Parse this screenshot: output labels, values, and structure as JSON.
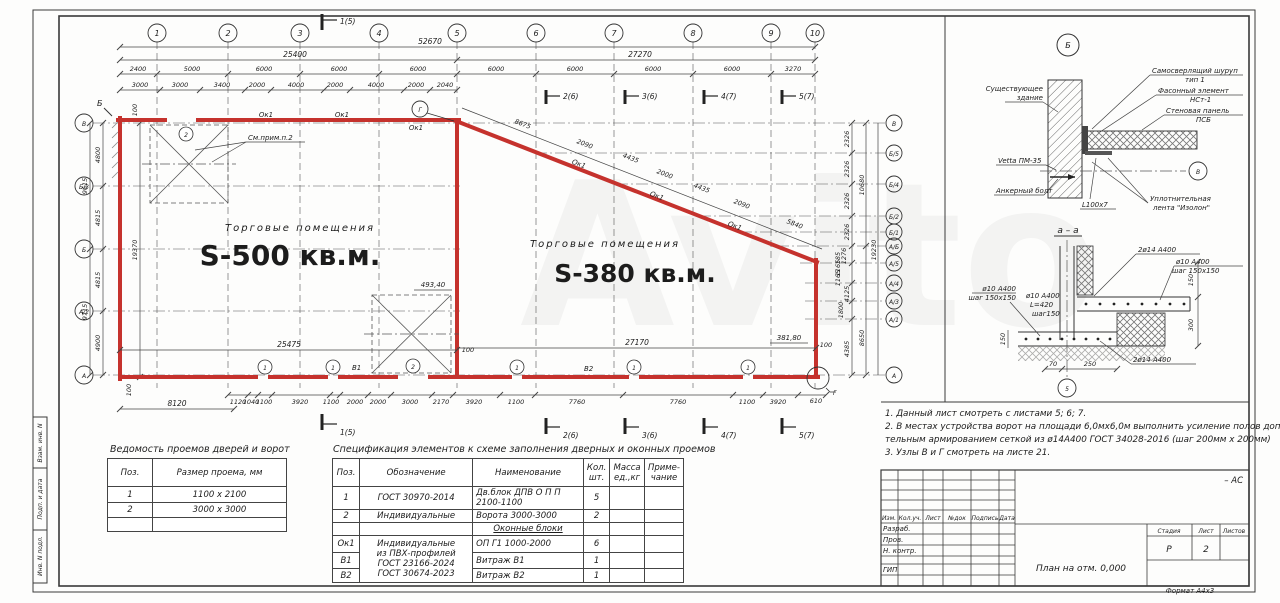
{
  "watermark": "Avito",
  "plan": {
    "axes_top": [
      "1",
      "2",
      "3",
      "4",
      "5",
      "6",
      "7",
      "8",
      "9",
      "10"
    ],
    "axes_left": [
      "В",
      "Б/3",
      "Б",
      "А/2",
      "А"
    ],
    "axes_right": [
      "В",
      "Б/5",
      "Б/4",
      "Б/2",
      "Б/1",
      "А/Б",
      "А/5",
      "А/4",
      "А/3",
      "А/1",
      "А"
    ],
    "dim_total": "52670",
    "dim_span_left": "25400",
    "dim_span_right": "27270",
    "dims_axis_row": [
      "2400",
      "5000",
      "6000",
      "6000",
      "6000",
      "6000",
      "6000",
      "6000",
      "6000",
      "3270"
    ],
    "dims_window_row": [
      "3000",
      "3000",
      "3400",
      "2000",
      "4000",
      "2000",
      "4000",
      "2000",
      "2040"
    ],
    "dims_diagonal": [
      "8675",
      "2090",
      "4435",
      "2000",
      "4435",
      "2090",
      "5840"
    ],
    "dims_bottom_row": [
      "1120",
      "1040",
      "1100",
      "3920",
      "1100",
      "2000",
      "2000",
      "3000",
      "2170",
      "3920",
      "1100",
      "7760",
      "7760",
      "1100",
      "3920",
      "610"
    ],
    "dim_bottom_left_start": "8120",
    "dim_bottom_span_left": "25475",
    "dim_bottom_span_right": "27170",
    "dims_left_inner": [
      "4800",
      "4815",
      "4815",
      "4900"
    ],
    "dims_left_outer": [
      "9615",
      "9715"
    ],
    "dim_left_overall": "19370",
    "dims_right_inner": [
      "2326",
      "2326",
      "2326",
      "2326",
      "1276",
      "185",
      "1165",
      "1165",
      "4125",
      "1800",
      "4385"
    ],
    "dims_right_outer": [
      "10680",
      "19230",
      "8650"
    ],
    "offset_100": "100",
    "room1_label": "Торговые помещения",
    "room1_area": "S-500 кв.м.",
    "room2_label": "Торговые помещения",
    "room2_area": "S-380 кв.м.",
    "note_ref": "См.прим.п.2",
    "elev_ramp": "493,40",
    "elev_corner": "381,80",
    "window_mark": "Ок1",
    "door_mark_1": "1",
    "gate_mark_2": "2",
    "vitrage_1": "В1",
    "vitrage_2": "В2",
    "node_top": "Б",
    "node_g": "Г",
    "sections": [
      "1(5)",
      "2(6)",
      "3(6)",
      "4(7)",
      "5(7)"
    ]
  },
  "detail_b": {
    "node": "Б",
    "existing_1": "Существующее",
    "existing_2": "здание",
    "vetta": "Vetta ПМ-35",
    "anchor": "Анкерный болт",
    "screw_1": "Самосверлящий шуруп",
    "screw_2": "тип 1",
    "element_1": "Фасонный элемент",
    "element_2": "НСт-1",
    "panel_1": "Стеновая панель",
    "panel_2": "ПСБ",
    "tape_1": "Уплотнительная",
    "tape_2": "лента \"Изолон\"",
    "angle": "L100x7",
    "axis_v": "В"
  },
  "section_aa": {
    "title": "а – а",
    "rebar_top": "2ø14 А400",
    "mesh_right_1": "ø10 А400",
    "mesh_right_2": "шаг 150х150",
    "mesh_left_1": "ø10 А400",
    "mesh_left_2": "шаг 150х150",
    "stirrup_1": "ø10 А400",
    "stirrup_2": "L=420",
    "stirrup_3": "шаг150",
    "rebar_bottom": "2ø14 А400",
    "dim_150a": "150",
    "dim_300": "300",
    "dim_150b": "150",
    "dim_70": "70",
    "dim_250": "250",
    "axis_5": "5"
  },
  "notes": {
    "line1": "1. Данный лист смотреть с листами 5; 6; 7.",
    "line2": "2. В местах устройства ворот на площади 6,0мх6,0м выполнить усиление полов дополни-",
    "line3": "тельным армированием сеткой из ø14А400 ГОСТ 34028-2016 (шаг 200мм х 200мм)",
    "line4": "3. Узлы В и Г смотреть на листе 21."
  },
  "table_doors": {
    "title": "Ведомость проемов дверей и ворот",
    "col1": "Поз.",
    "col2": "Размер проема, мм",
    "rows": [
      {
        "pos": "1",
        "size": "1100 х 2100"
      },
      {
        "pos": "2",
        "size": "3000 х 3000"
      }
    ]
  },
  "table_spec": {
    "title": "Спецификация элементов к схеме заполнения дверных и оконных проемов",
    "h_pos": "Поз.",
    "h_desig": "Обозначение",
    "h_name": "Наименование",
    "h_qty1": "Кол.",
    "h_qty2": "шт.",
    "h_mass1": "Масса",
    "h_mass2": "ед.,кг",
    "h_note1": "Приме-",
    "h_note2": "чание",
    "r1": {
      "pos": "1",
      "desig": "ГОСТ 30970-2014",
      "name": "Дв.блок ДПВ О П П 2100-1100",
      "qty": "5"
    },
    "r2": {
      "pos": "2",
      "desig": "Индивидуальные",
      "name": "Ворота 3000-3000",
      "qty": "2"
    },
    "sub": "Оконные блоки",
    "merged_desig_1": "Индивидуальные",
    "merged_desig_2": "из ПВХ-профилей",
    "merged_desig_3": "ГОСТ 23166-2024",
    "merged_desig_4": "ГОСТ 30674-2023",
    "r4": {
      "pos": "Ок1",
      "name": "ОП Г1 1000-2000",
      "qty": "6"
    },
    "r5": {
      "pos": "В1",
      "name": "Витраж В1",
      "qty": "1"
    },
    "r6": {
      "pos": "В2",
      "name": "Витраж В2",
      "qty": "1"
    }
  },
  "titleblock": {
    "cols": [
      "Изм.",
      "Кол.уч.",
      "Лист",
      "№док",
      "Подпись",
      "Дата"
    ],
    "rows": [
      "Разраб.",
      "Пров.",
      "Н. контр.",
      "ГИП"
    ],
    "doc_title": "План на отм. 0,000",
    "stage_h": "Стадия",
    "sheet_h": "Лист",
    "sheets_h": "Листов",
    "stage": "Р",
    "sheet": "2",
    "code": "– АС",
    "format": "Формат А4х3"
  },
  "side_stamp": {
    "c1": "Взам. инв. N",
    "c2": "Подп. и дата",
    "c3": "Инв. N подл."
  }
}
